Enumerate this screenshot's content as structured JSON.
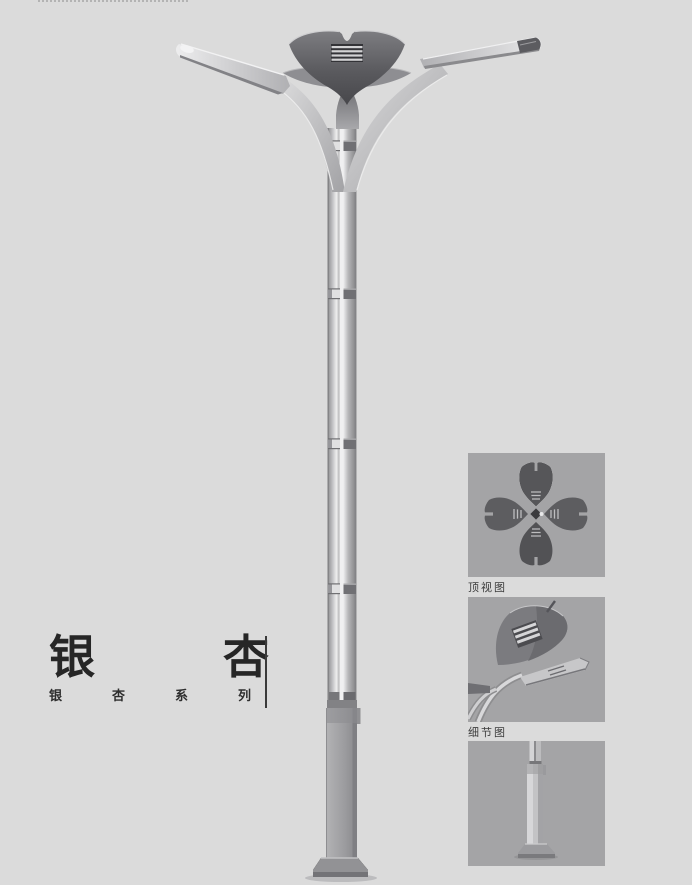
{
  "product": {
    "title": "银杏",
    "series": "银杏系列"
  },
  "thumbnails": [
    {
      "id": "top-view",
      "label": "顶视图"
    },
    {
      "id": "detail-view",
      "label": "细节图"
    },
    {
      "id": "base-view",
      "label": ""
    }
  ],
  "icons": {
    "main_illustration": "ginkgo-street-lamp",
    "thumb_top": "lamp-top-view-four-leaves",
    "thumb_detail": "lamp-head-detail",
    "thumb_base": "pole-base"
  },
  "colors": {
    "page_bg": "#dbdbdb",
    "thumb_bg": "#a4a4a6",
    "title_text": "#262626",
    "caption_text": "#3c3c3c",
    "lamp_dark": "#4a4a4e",
    "lamp_metal": "#b5b5b7"
  }
}
